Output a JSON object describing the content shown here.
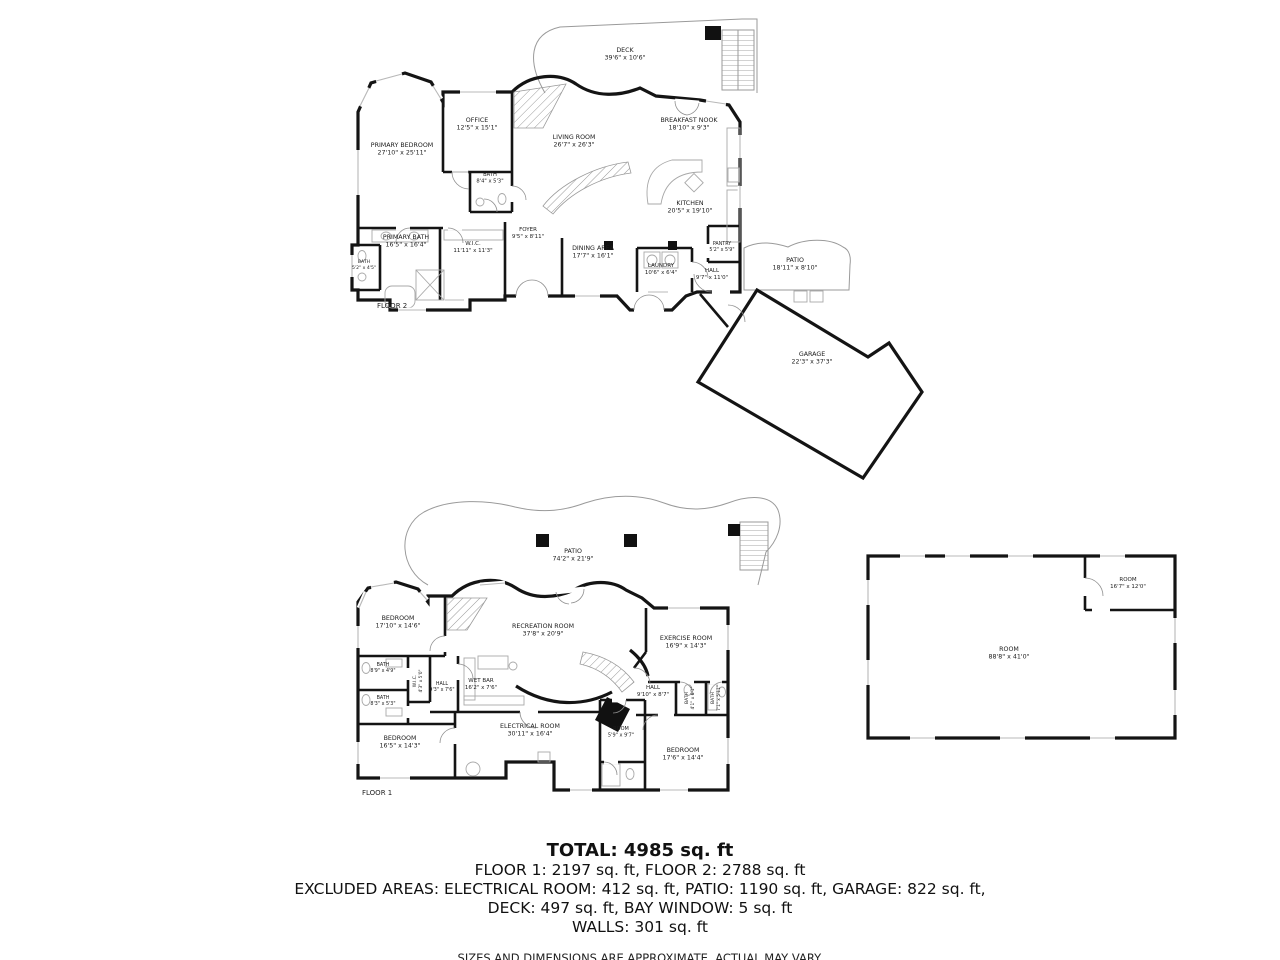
{
  "colors": {
    "wall": "#141414",
    "background": "#ffffff",
    "thin_line": "#9a9a9a"
  },
  "floor2": {
    "label": "FLOOR 2",
    "rooms": [
      {
        "name": "DECK",
        "dims": "39'6\" x 10'6\"",
        "x": 625,
        "y": 54
      },
      {
        "name": "PRIMARY BEDROOM",
        "dims": "27'10\" x 25'11\"",
        "x": 402,
        "y": 149
      },
      {
        "name": "OFFICE",
        "dims": "12'5\" x 15'1\"",
        "x": 477,
        "y": 124
      },
      {
        "name": "BATH",
        "dims": "8'4\" x 5'3\"",
        "x": 490,
        "y": 178,
        "fs": 5.2
      },
      {
        "name": "LIVING ROOM",
        "dims": "26'7\" x 26'3\"",
        "x": 574,
        "y": 141
      },
      {
        "name": "BREAKFAST NOOK",
        "dims": "18'10\" x 9'3\"",
        "x": 689,
        "y": 124
      },
      {
        "name": "KITCHEN",
        "dims": "20'5\" x 19'10\"",
        "x": 690,
        "y": 207
      },
      {
        "name": "FOYER",
        "dims": "9'5\" x 8'11\"",
        "x": 528,
        "y": 233,
        "fs": 5.5
      },
      {
        "name": "DINING AREA",
        "dims": "17'7\" x 16'1\"",
        "x": 593,
        "y": 252
      },
      {
        "name": "LAUNDRY",
        "dims": "10'6\" x 6'4\"",
        "x": 661,
        "y": 269,
        "fs": 5.5
      },
      {
        "name": "PANTRY",
        "dims": "5'2\" x 5'9\"",
        "x": 722,
        "y": 247,
        "fs": 4.8
      },
      {
        "name": "HALL",
        "dims": "9'7\" x 11'0\"",
        "x": 712,
        "y": 274,
        "fs": 5.5
      },
      {
        "name": "PRIMARY BATH",
        "dims": "16'5\" x 16'4\"",
        "x": 406,
        "y": 241
      },
      {
        "name": "BATH",
        "dims": "5'2\" x 4'5\"",
        "x": 364,
        "y": 265,
        "fs": 4.6
      },
      {
        "name": "W.I.C.",
        "dims": "11'11\" x 11'3\"",
        "x": 473,
        "y": 247,
        "fs": 5.5
      },
      {
        "name": "PATIO",
        "dims": "18'11\" x 8'10\"",
        "x": 795,
        "y": 264
      },
      {
        "name": "GARAGE",
        "dims": "22'3\" x 37'3\"",
        "x": 812,
        "y": 358
      }
    ]
  },
  "floor1": {
    "label": "FLOOR 1",
    "rooms": [
      {
        "name": "PATIO",
        "dims": "74'2\" x 21'9\"",
        "x": 573,
        "y": 555
      },
      {
        "name": "BEDROOM",
        "dims": "17'10\" x 14'6\"",
        "x": 398,
        "y": 622
      },
      {
        "name": "RECREATION ROOM",
        "dims": "37'8\" x 20'9\"",
        "x": 543,
        "y": 630
      },
      {
        "name": "EXERCISE ROOM",
        "dims": "16'9\" x 14'3\"",
        "x": 686,
        "y": 642
      },
      {
        "name": "BATH",
        "dims": "8'9\" x 4'9\"",
        "x": 383,
        "y": 668,
        "fs": 4.8
      },
      {
        "name": "BATH",
        "dims": "8'3\" x 5'3\"",
        "x": 383,
        "y": 701,
        "fs": 4.8
      },
      {
        "name": "W.I.C.",
        "dims": "4'3\" x 5'0\"",
        "x": 418,
        "y": 681,
        "fs": 4.4,
        "rot": -90
      },
      {
        "name": "HALL",
        "dims": "9'3\" x 7'6\"",
        "x": 442,
        "y": 687,
        "fs": 4.8
      },
      {
        "name": "WET BAR",
        "dims": "16'2\" x 7'6\"",
        "x": 481,
        "y": 684,
        "fs": 5.5
      },
      {
        "name": "HALL",
        "dims": "9'10\" x 8'7\"",
        "x": 653,
        "y": 691,
        "fs": 5.5
      },
      {
        "name": "BATH",
        "dims": "4'1\" x 6'1\"",
        "x": 690,
        "y": 698,
        "fs": 4.4,
        "rot": -90
      },
      {
        "name": "BATH",
        "dims": "7'1\" x 5'11\"",
        "x": 716,
        "y": 698,
        "fs": 4.4,
        "rot": -90
      },
      {
        "name": "BEDROOM",
        "dims": "16'5\" x 14'3\"",
        "x": 400,
        "y": 742
      },
      {
        "name": "ELECTRICAL ROOM",
        "dims": "30'11\" x 16'4\"",
        "x": 530,
        "y": 730
      },
      {
        "name": "ROOM",
        "dims": "5'9\" x 9'7\"",
        "x": 621,
        "y": 732,
        "fs": 5
      },
      {
        "name": "BEDROOM",
        "dims": "17'6\" x 14'4\"",
        "x": 683,
        "y": 754
      }
    ]
  },
  "outbuilding": {
    "rooms": [
      {
        "name": "ROOM",
        "dims": "16'7\" x 12'0\"",
        "x": 1128,
        "y": 583,
        "fs": 5.5
      },
      {
        "name": "ROOM",
        "dims": "88'8\" x 41'0\"",
        "x": 1009,
        "y": 653
      }
    ]
  },
  "summary": {
    "total": "TOTAL: 4985 sq. ft",
    "line2": "FLOOR 1: 2197 sq. ft, FLOOR 2: 2788 sq. ft",
    "line3": "EXCLUDED AREAS: ELECTRICAL ROOM: 412 sq. ft, PATIO: 1190 sq. ft, GARAGE: 822 sq. ft,",
    "line4": "DECK: 497 sq. ft, BAY WINDOW: 5 sq. ft",
    "line5": "WALLS: 301 sq. ft",
    "disclaimer": "SIZES AND DIMENSIONS ARE APPROXIMATE, ACTUAL MAY VARY."
  }
}
